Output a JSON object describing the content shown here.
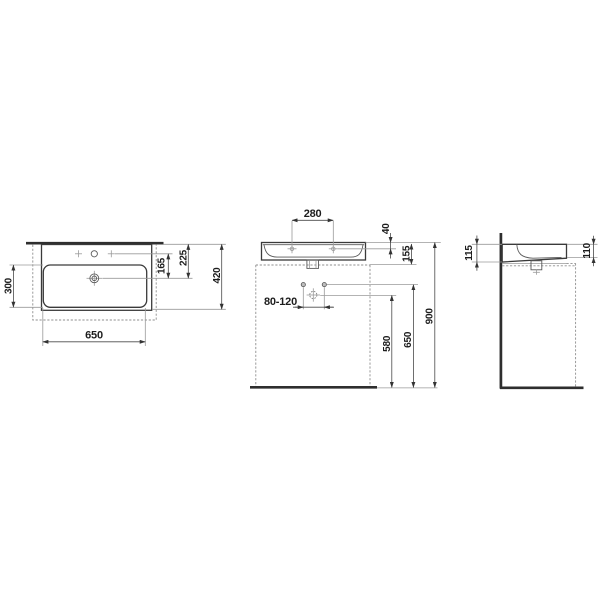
{
  "plan": {
    "bowl_depth": "300",
    "basin_width": "650",
    "faucet_to_drain": "165",
    "front_to_drain": "225",
    "basin_depth": "420"
  },
  "front": {
    "tap_hole_spacing": "280",
    "rim_to_tap_line": "40",
    "basin_height": "155",
    "overall_height": "900",
    "supply_height": "650",
    "waste_height": "580",
    "supply_spacing": "80-120"
  },
  "side": {
    "height_at_wall": "115",
    "height_at_front": "110"
  },
  "colors": {
    "line_dark": "#3a3a3a",
    "line_grey": "#9a9a9a",
    "background": "#ffffff"
  }
}
